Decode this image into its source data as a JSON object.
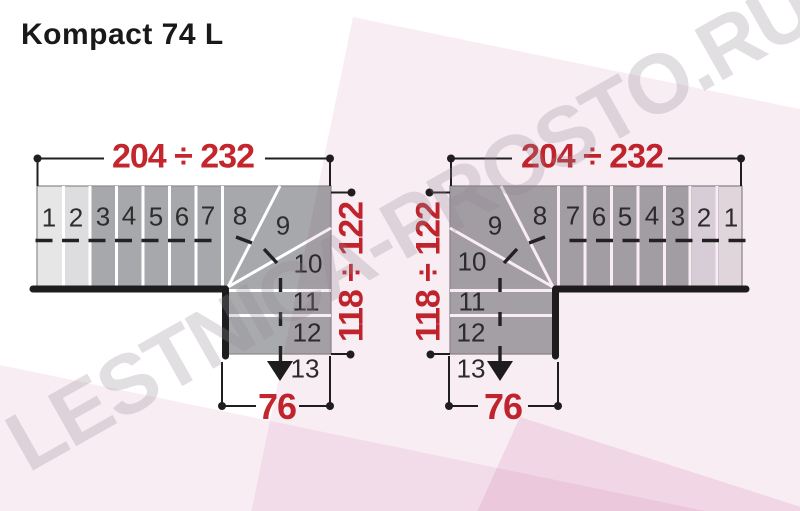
{
  "title": "Kompact 74 L",
  "watermark": "LESTNICA-PROSTO.RU",
  "colors": {
    "dimension_red": "#c4262e",
    "step_dark": "#a6a8ab",
    "step_light_1": "#e7e6e6",
    "step_light_2": "#dddddе",
    "wall_black": "#1d1d1d",
    "background_pink": "#f9edf4"
  },
  "left_plan": {
    "width_dim": "204 ÷ 232",
    "height_dim": "118 ÷ 122",
    "exit_dim": "76",
    "steps": [
      "1",
      "2",
      "3",
      "4",
      "5",
      "6",
      "7",
      "8",
      "9",
      "10",
      "11",
      "12",
      "13"
    ]
  },
  "right_plan": {
    "width_dim": "204 ÷ 232",
    "height_dim": "118 ÷ 122",
    "exit_dim": "76",
    "steps": [
      "1",
      "2",
      "3",
      "4",
      "5",
      "6",
      "7",
      "8",
      "9",
      "10",
      "11",
      "12",
      "13"
    ]
  }
}
